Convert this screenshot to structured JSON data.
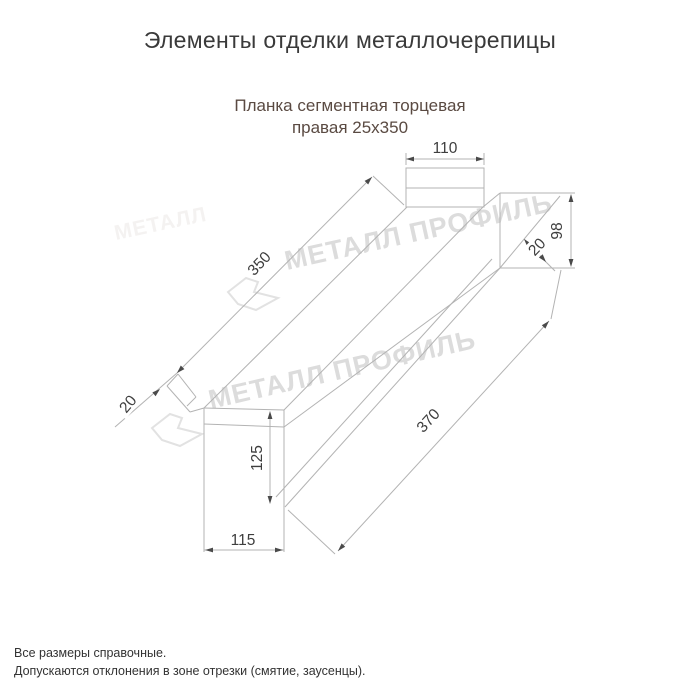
{
  "header": {
    "title": "Элементы отделки металлочерепицы",
    "subtitle_line1": "Планка сегментная торцевая",
    "subtitle_line2": "правая 25х350"
  },
  "drawing": {
    "watermark_text": "МЕТАЛЛ ПРОФИЛЬ",
    "watermark_faint_text": "МЕТАЛЛ",
    "dims": {
      "top_width": "110",
      "length_top": "350",
      "end_height": "98",
      "hem_right": "20",
      "hem_left": "20",
      "face_height": "125",
      "length_bottom": "370",
      "face_width": "115"
    },
    "colors": {
      "line": "#b3b3b3",
      "dim_text": "#3e3e3e",
      "arrow": "#4a4a4a",
      "watermark": "#dcdcdc",
      "subtitle_text": "#5a4a42"
    }
  },
  "footer": {
    "line1": "Все размеры справочные.",
    "line2": "Допускаются отклонения в зоне отрезки (смятие, заусенцы)."
  }
}
